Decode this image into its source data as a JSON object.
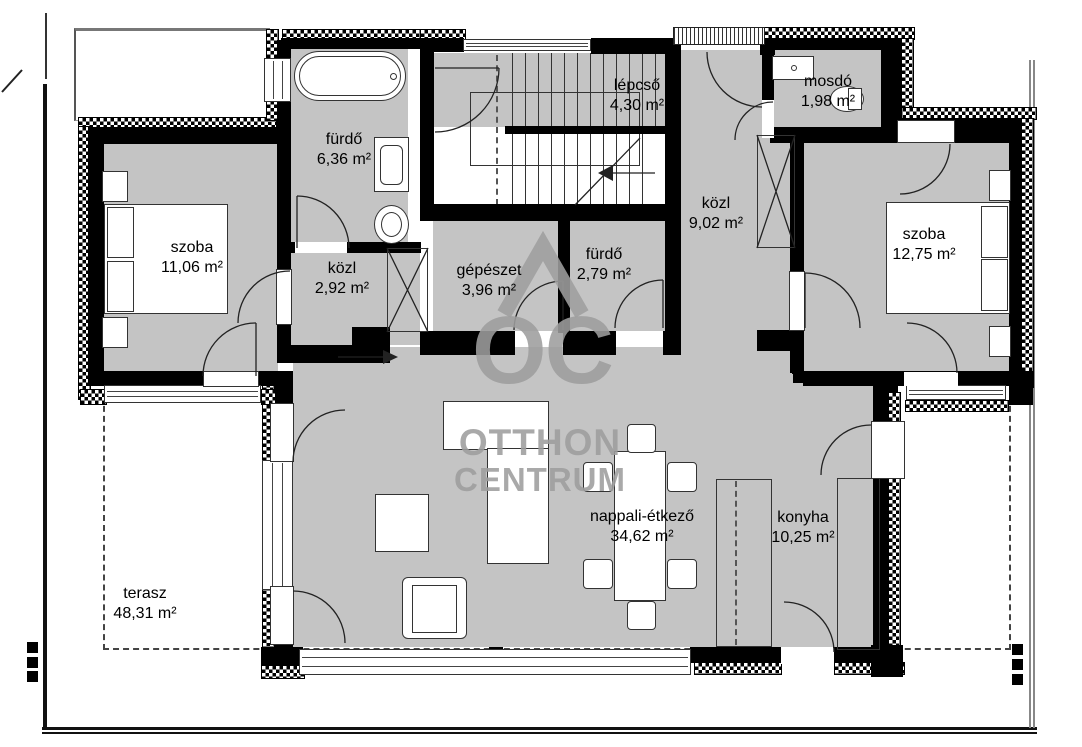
{
  "rooms": [
    {
      "name": "szoba",
      "area": "11,06 m²"
    },
    {
      "name": "fürdő",
      "area": "6,36 m²"
    },
    {
      "name": "közl",
      "area": "2,92 m²"
    },
    {
      "name": "gépészet",
      "area": "3,96 m²"
    },
    {
      "name": "fürdő",
      "area": "2,79 m²"
    },
    {
      "name": "lépcső",
      "area": "4,30 m²"
    },
    {
      "name": "mosdó",
      "area": "1,98 m²"
    },
    {
      "name": "közl",
      "area": "9,02 m²"
    },
    {
      "name": "szoba",
      "area": "12,75 m²"
    },
    {
      "name": "nappali-étkező",
      "area": "34,62 m²"
    },
    {
      "name": "konyha",
      "area": "10,25 m²"
    },
    {
      "name": "terasz",
      "area": "48,31 m²"
    }
  ],
  "watermark": {
    "oc": "OC",
    "line1": "OTTHON",
    "line2": "CENTRUM"
  },
  "colors": {
    "room_fill": "#c4c4c4",
    "wall": "#000000",
    "watermark": "#9e9e9e"
  }
}
